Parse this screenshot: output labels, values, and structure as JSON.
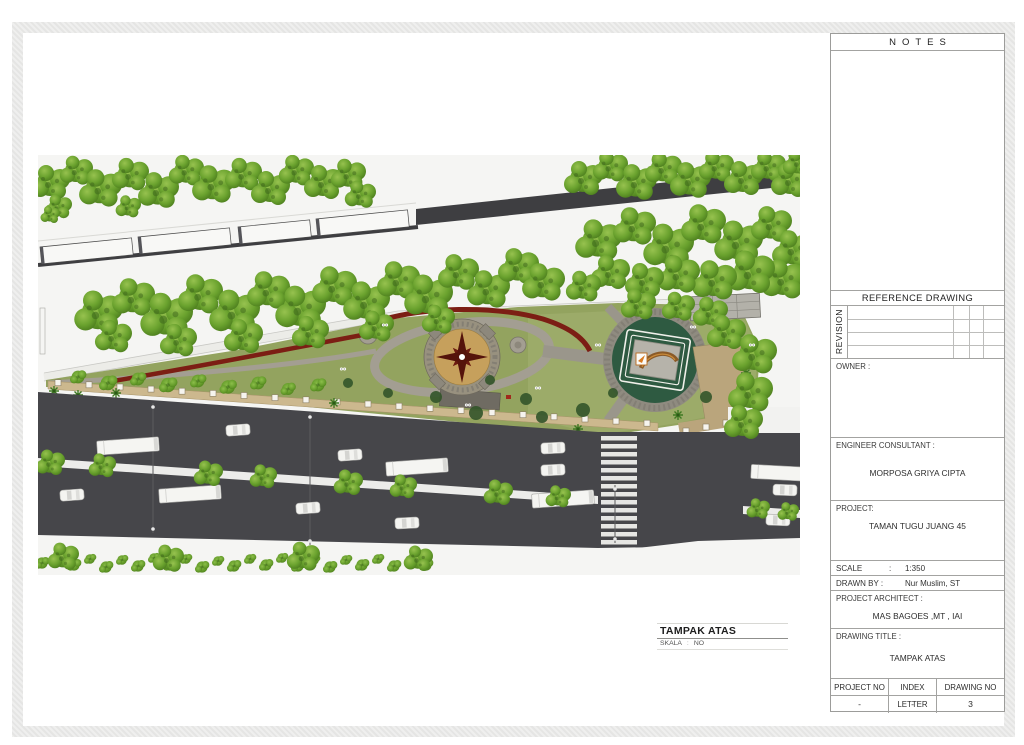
{
  "colors": {
    "asphalt": "#46464a",
    "grass_olive": "#93a35f",
    "grass_light": "#9cab69",
    "tree_green": "#6aa22e",
    "hedge_red": "#7c1e14",
    "compass_tan": "#c6a05c",
    "monument_green": "#2e5a41",
    "stone_gray": "#9a948a",
    "sand_tan": "#ccb88e"
  },
  "title_block": {
    "notes_title": "NOTES",
    "reference_drawing_title": "REFERENCE DRAWING",
    "revision_label": "REVISION",
    "owner_label": "OWNER :",
    "engineer_consultant_label": "ENGINEER CONSULTANT :",
    "engineer_consultant_name": "MORPOSA GRIYA CIPTA",
    "project_label": "PROJECT:",
    "project_name": "TAMAN TUGU JUANG 45",
    "scale_label": "SCALE",
    "scale_colon": ":",
    "scale_value": "1:350",
    "drawn_by_label": "DRAWN BY :",
    "drawn_by_value": "Nur Muslim, ST",
    "project_architect_label": "PROJECT ARCHITECT :",
    "project_architect_name": "MAS  BAGOES   ,MT , IAI",
    "drawing_title_label": "DRAWING TITLE :",
    "drawing_title_value": "TAMPAK ATAS",
    "project_no_label": "PROJECT NO",
    "project_no_value": "-",
    "index_letter_label": "INDEX LETTER",
    "index_letter_value": "-",
    "drawing_no_label": "DRAWING NO",
    "drawing_no_value": "3"
  },
  "plan_caption": {
    "title": "TAMPAK ATAS",
    "scale_label": "SKALA",
    "scale_colon": ":",
    "scale_value": "NO"
  }
}
